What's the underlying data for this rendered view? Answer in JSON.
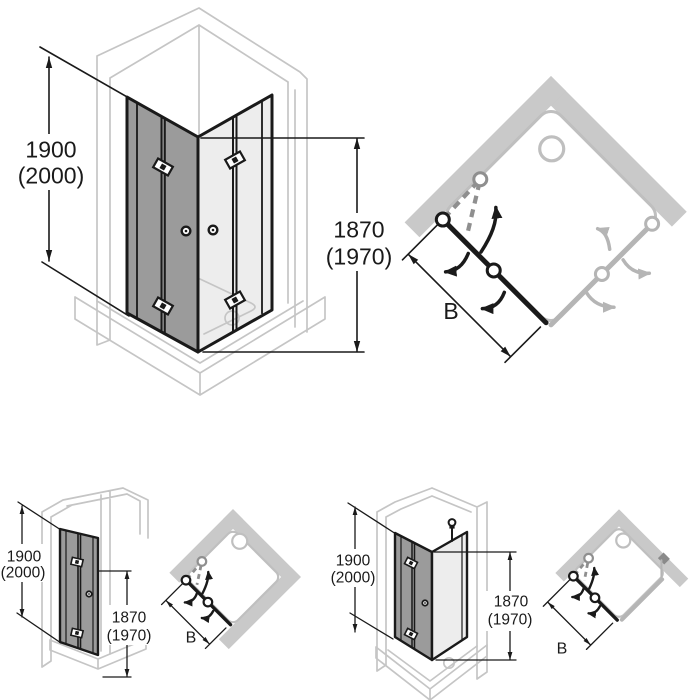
{
  "diagram": {
    "type": "shower-enclosure-folding-door-technical-drawing",
    "views": {
      "corner_entry_3d": {
        "height_outer": "1900",
        "height_outer_alt": "(2000)",
        "height_inner": "1870",
        "height_inner_alt": "(1970)"
      },
      "corner_entry_plan": {
        "width": "B"
      },
      "recess_3d": {
        "height_outer": "1900",
        "height_outer_alt": "(2000)",
        "height_inner": "1870",
        "height_inner_alt": "(1970)"
      },
      "recess_plan": {
        "width": "B"
      },
      "corner_panel_3d": {
        "height_outer": "1900",
        "height_outer_alt": "(2000)",
        "height_inner": "1870",
        "height_inner_alt": "(1970)"
      },
      "corner_panel_plan": {
        "width": "B"
      }
    },
    "colors": {
      "line_black": "#1a1a1a",
      "glass_dark": "#9b9b9b",
      "glass_light": "#ededed",
      "wall_fill": "#c9c9c9",
      "gray_outline": "#c5c5c5",
      "door_gray": "#b5b5b5",
      "fold_dash_gray": "#8f8f8f"
    }
  }
}
